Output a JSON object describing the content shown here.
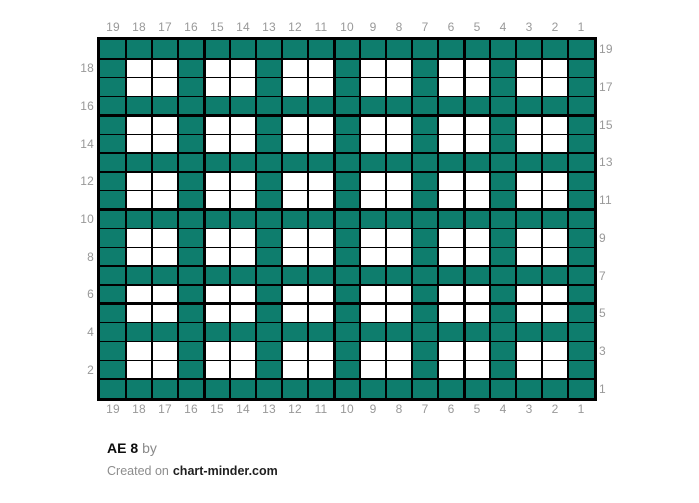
{
  "title": {
    "name": "AE 8",
    "byline": "by"
  },
  "footer": {
    "prefix": "Created on",
    "site": "chart-minder.com"
  },
  "colors": {
    "yarn_teal": "#0e7d6d",
    "yarn_white": "#ffffff",
    "grid_line": "#000000",
    "axis_label": "#999999"
  },
  "chart_data": {
    "type": "heatmap",
    "title": "AE 8",
    "grid_size": {
      "columns": 19,
      "rows": 19
    },
    "palette": {
      "1": "#0e7d6d",
      "0": "#ffffff"
    },
    "major_grid_every": 5,
    "axis_labels": {
      "top": [
        "19",
        "18",
        "17",
        "16",
        "15",
        "14",
        "13",
        "12",
        "11",
        "10",
        "9",
        "8",
        "7",
        "6",
        "5",
        "4",
        "3",
        "2",
        "1"
      ],
      "bottom": [
        "19",
        "18",
        "17",
        "16",
        "15",
        "14",
        "13",
        "12",
        "11",
        "10",
        "9",
        "8",
        "7",
        "6",
        "5",
        "4",
        "3",
        "2",
        "1"
      ],
      "left": [
        "18",
        "16",
        "14",
        "12",
        "10",
        "8",
        "6",
        "4",
        "2"
      ],
      "right": [
        "19",
        "17",
        "15",
        "13",
        "11",
        "9",
        "7",
        "5",
        "3",
        "1"
      ]
    },
    "rows": [
      "1111111111111111111",
      "1001001001001001001",
      "1001001001001001001",
      "1111111111111111111",
      "1001001001001001001",
      "1001001001001001001",
      "1111111111111111111",
      "1001001001001001001",
      "1001001001001001001",
      "1111111111111111111",
      "1001001001001001001",
      "1001001001001001001",
      "1111111111111111111",
      "1001001001001001001",
      "1001001001001001001",
      "1111111111111111111",
      "1001001001001001001",
      "1001001001001001001",
      "1111111111111111111"
    ]
  }
}
